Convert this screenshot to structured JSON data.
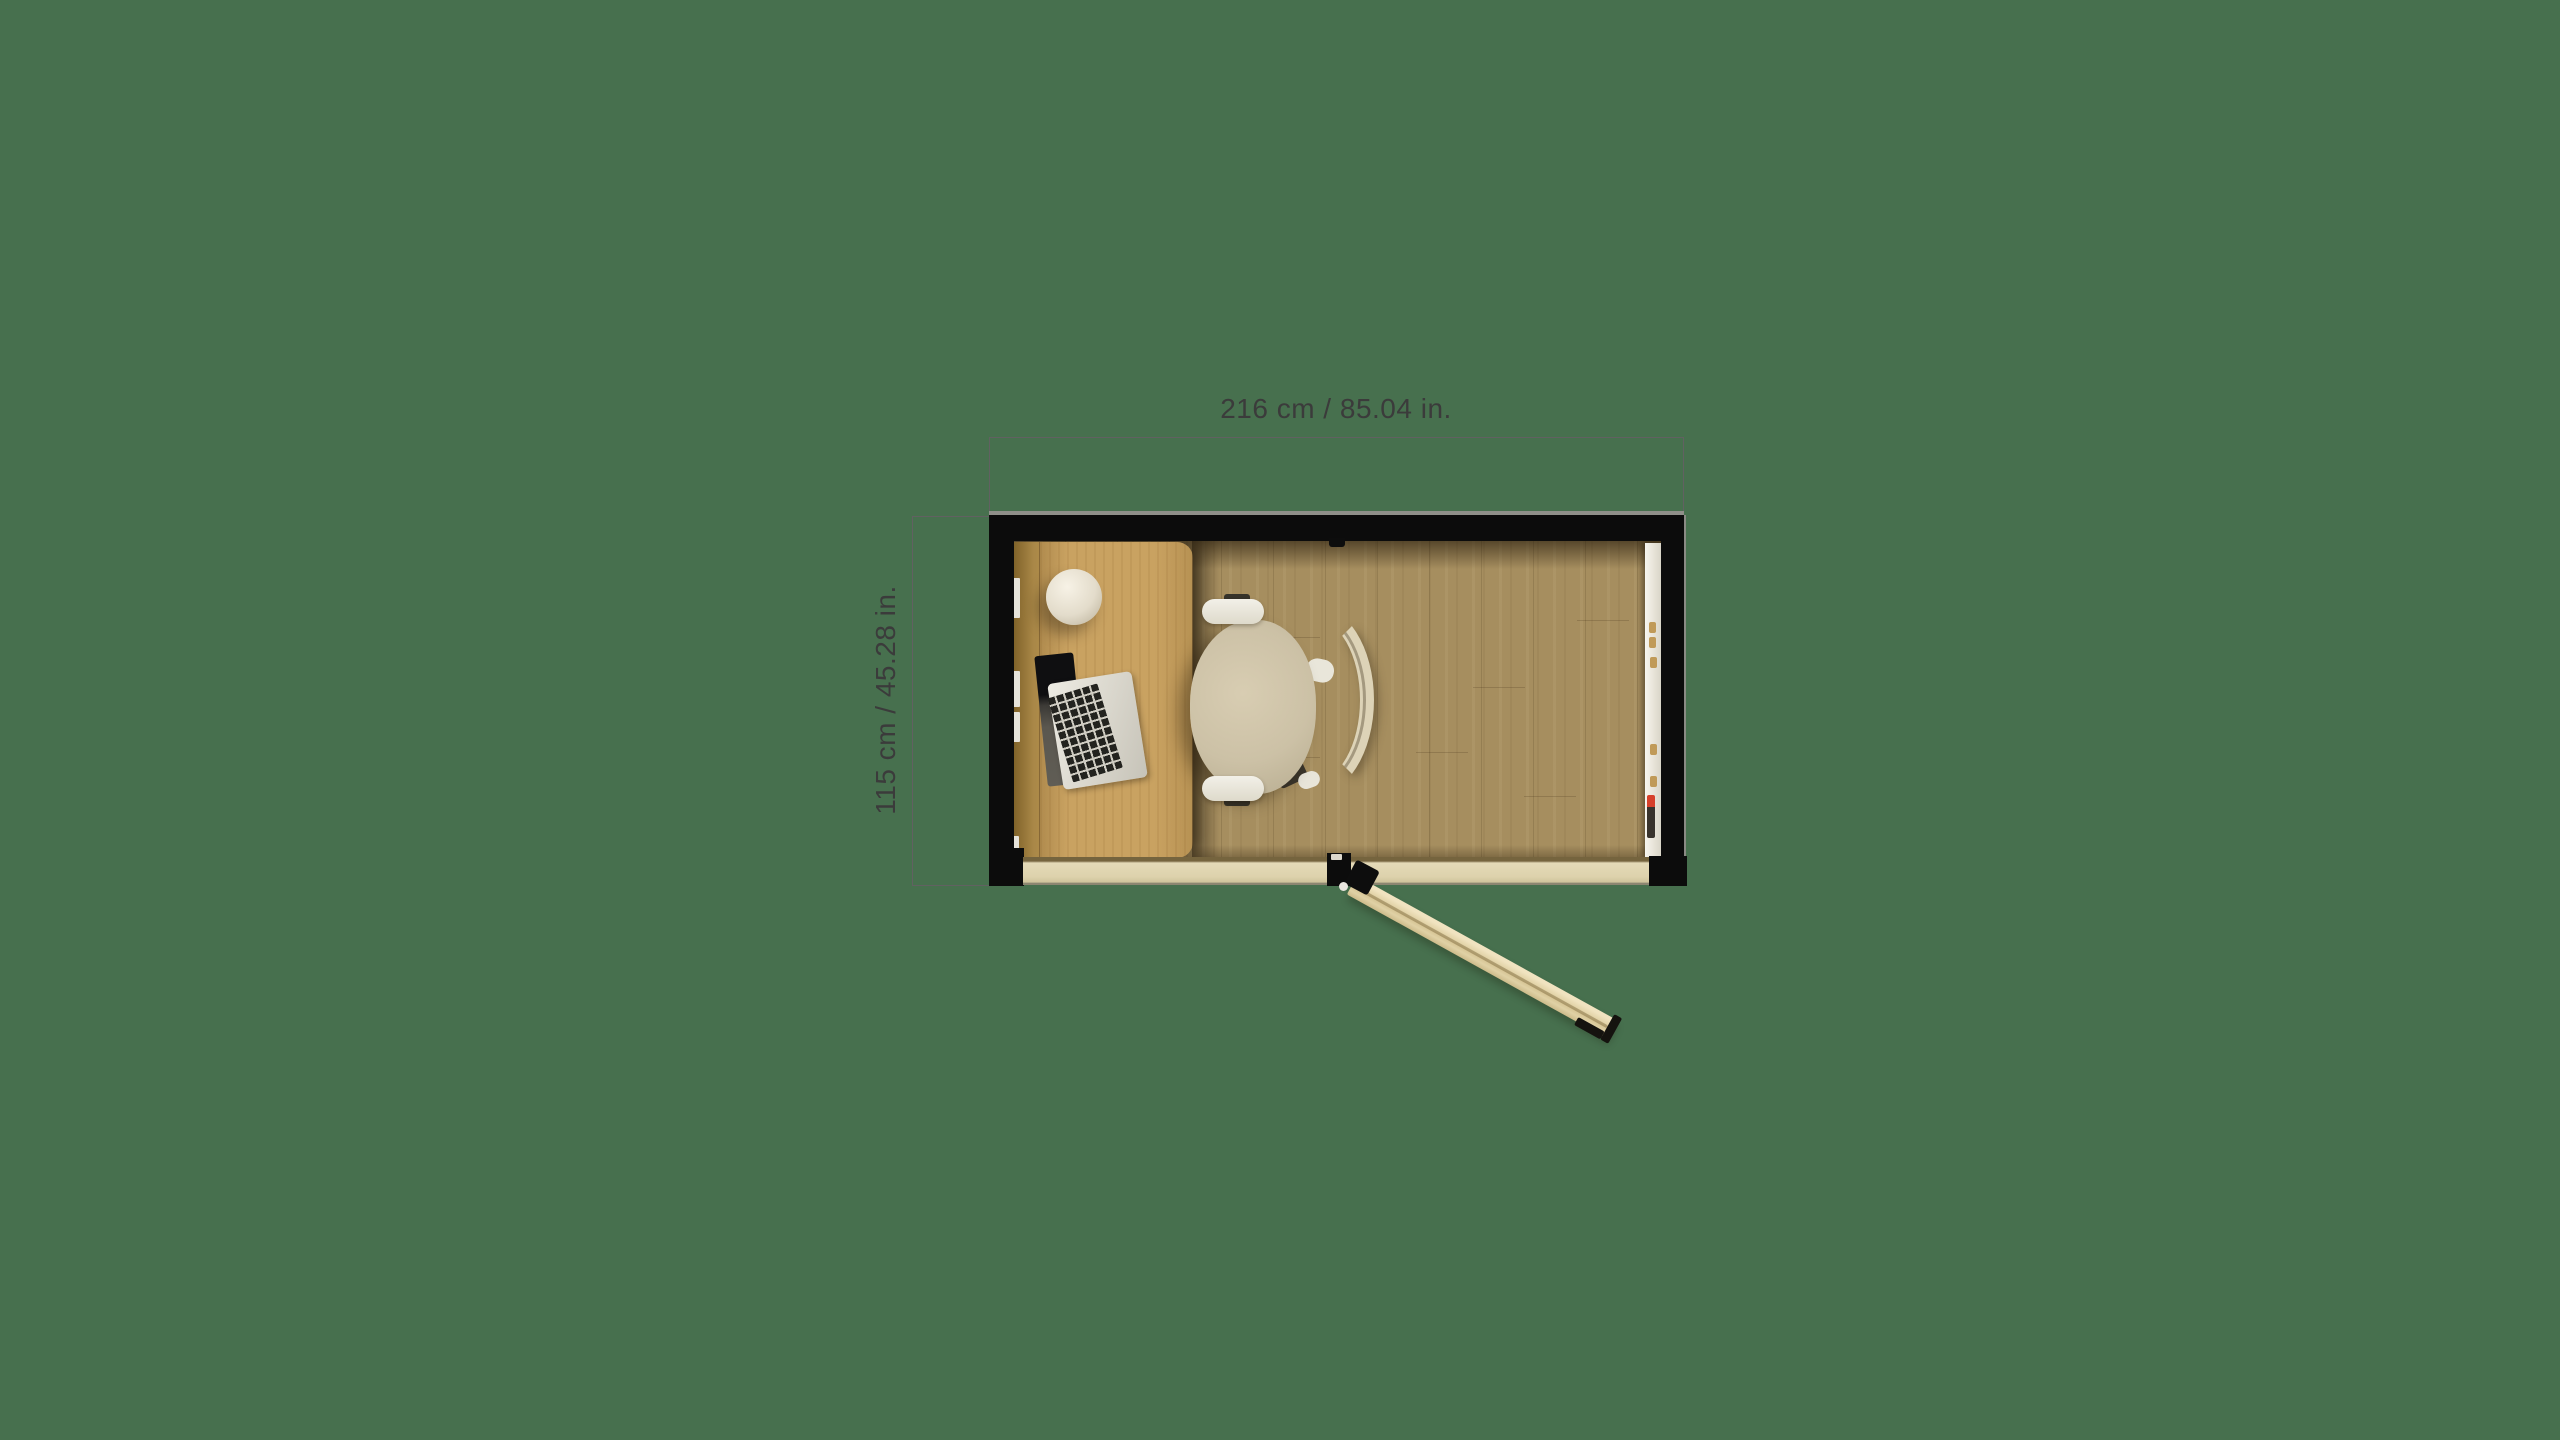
{
  "page": {
    "background_color": "#47704e"
  },
  "floorplan": {
    "view": "top-down office pod plan",
    "annotations": {
      "width_label": "216 cm / 85.04 in.",
      "height_label": "115 cm / 45.28 in.",
      "text_color": "#3b3b3b",
      "line_color": "#616161"
    },
    "room": {
      "wall_color": "#0c0c0c",
      "floor_color": "#a68e5f",
      "threshold_color": "#ddd2ac",
      "door": {
        "state": "open",
        "swing_angle_deg": 29,
        "leaf_color": "#e3d4a9",
        "handle_color": "#15130f"
      },
      "furniture": [
        {
          "name": "desk",
          "color": "#c9a261"
        },
        {
          "name": "desk-side-panel",
          "color": "#a98747"
        },
        {
          "name": "office-chair",
          "seat_color": "#ccc1a6",
          "backrest_color": "#ddd3b7",
          "armrest_color": "#eceadf"
        },
        {
          "name": "laptop",
          "body_color": "#d6d3c9",
          "keys_color": "#23231f",
          "screen_color": "#5a574f"
        },
        {
          "name": "sphere-lamp",
          "color": "#e9e2d1"
        },
        {
          "name": "whiteboard-rail",
          "color": "#f1efe8",
          "magnet_color": "#c09a58",
          "marker_cap_color": "#d6402b",
          "marker_body_color": "#38332d"
        }
      ]
    }
  }
}
